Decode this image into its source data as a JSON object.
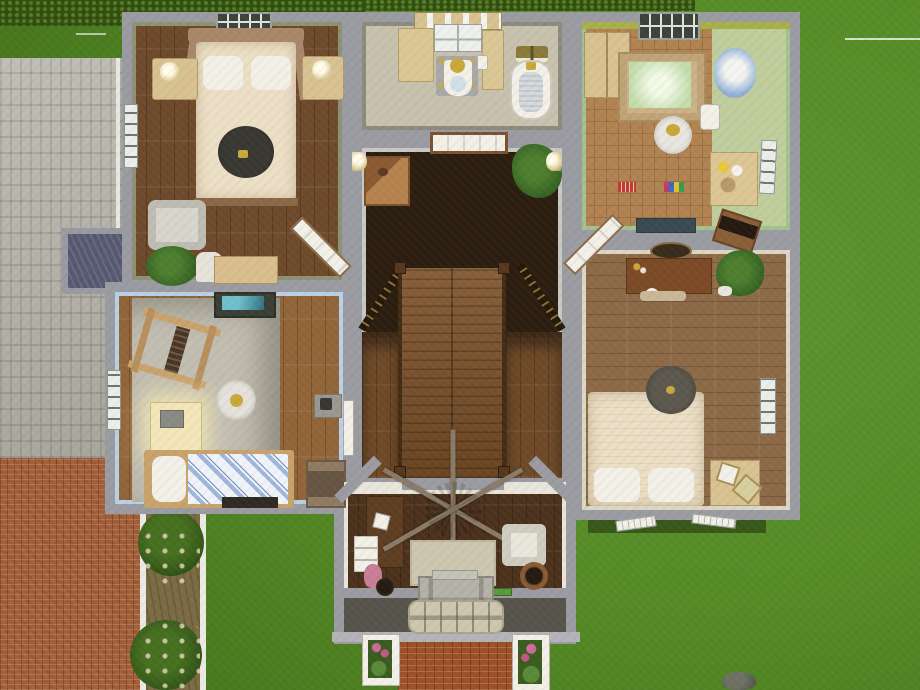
{
  "app": {
    "name": "life-sim dollhouse top-down view",
    "view": "upper floor cutaway of a suburban house",
    "visible_text": []
  },
  "palette": {
    "grass1": "#568c26",
    "grass2": "#5d9430",
    "grassDark": "#3f6b18",
    "hedge": "#2f4f0e",
    "hedgeDot": "#5a7c28",
    "roof": "#b7b4a9",
    "roofLine": "#a3a096",
    "gutter": "#e8e7e2",
    "patioBrick": "#a5603a",
    "walkBrick": "#9c5128",
    "dirt": "#7c6c44",
    "pathEdge": "#eceae4",
    "bush": "#2c4e16",
    "bushLight": "#47701f",
    "flowerDot": "#e9d9c2",
    "wallOuter": "#9b9ba2",
    "masterWall": "#8d9277",
    "masterFloor": "#6e4a2b",
    "bathWall": "#8d8b7d",
    "bathFloor": "#c7c1ad",
    "hallWall": "#c9c8c3",
    "hallFloor": "#2b1e11",
    "nurseryWall": "#a2c28f",
    "nurseryFloor": "#b28351",
    "mint": "#c2dcaa",
    "bed2Wall": "#dcd6c4",
    "bed2Floor": "#8d6a47",
    "blueWall": "#b9d0e7",
    "blueFloor": "#926539",
    "blueRug": "#c2beb1",
    "foyerWall": "#e9e5da",
    "foyerFloor": "#4c321c",
    "porch": "#56544b",
    "mat": "#cdc7b0",
    "stair": "#7d5129",
    "stairDark": "#2a1c0f",
    "flankFloor": "#6f4a28",
    "rail": "#58381c",
    "skylight": "#565870",
    "cream": "#ecdfc6",
    "white": "#f3f0e8",
    "tan": "#d9c291",
    "woodMid": "#b5824e",
    "woodDark": "#5f3e22",
    "leaf": "#336023",
    "leafLight": "#4d7f2e",
    "gold": "#c9a83c",
    "blueAccent": "#8fb0d8",
    "red": "#c23b2e",
    "teal": "#4f9aa8",
    "pink": "#c77f96"
  },
  "rooms": [
    {
      "id": "master-bedroom",
      "label": "master bedroom",
      "furniture": [
        "canopy double bed",
        "pet bed",
        "two nightstands with lamps",
        "armchair",
        "potted plant",
        "desk and chair",
        "windows",
        "diagonal door"
      ]
    },
    {
      "id": "bathroom",
      "label": "bathroom",
      "furniture": [
        "toilet",
        "clawfoot tub",
        "sink counters",
        "mirror cabinet",
        "towel rack",
        "window"
      ]
    },
    {
      "id": "stair-hall",
      "label": "stair hall and landing",
      "furniture": [
        "console cabinet",
        "palm plant",
        "wall sconces",
        "staircase",
        "railings"
      ]
    },
    {
      "id": "nursery",
      "label": "nursery",
      "furniture": [
        "crib",
        "dresser",
        "high chair",
        "potty",
        "round table",
        "changing table",
        "toys",
        "toy box",
        "windows"
      ]
    },
    {
      "id": "bedroom-2",
      "label": "right bedroom",
      "furniture": [
        "desk with clutter",
        "mirror",
        "potted plant",
        "double bed",
        "pet bed",
        "nightstand",
        "window"
      ]
    },
    {
      "id": "kids-room",
      "label": "blue kids room",
      "furniture": [
        "easel",
        "activity table",
        "glowing desk",
        "round rug",
        "single striped bed",
        "dresser",
        "wall shelf",
        "window"
      ]
    },
    {
      "id": "foyer",
      "label": "foyer living room",
      "furniture": [
        "ceiling fan",
        "wardrobe",
        "white shelf",
        "toys",
        "rug",
        "armchair",
        "planter pot",
        "front door",
        "porch mat"
      ]
    }
  ],
  "exterior": {
    "features": [
      "hedge row",
      "tiled roof with skylight",
      "chimney",
      "brick patio",
      "dirt path with white edging",
      "flowering bushes",
      "front brick walkway",
      "flower planter boxes",
      "lawn",
      "rock",
      "lot boundary line",
      "window shutters leaning on wall"
    ]
  }
}
